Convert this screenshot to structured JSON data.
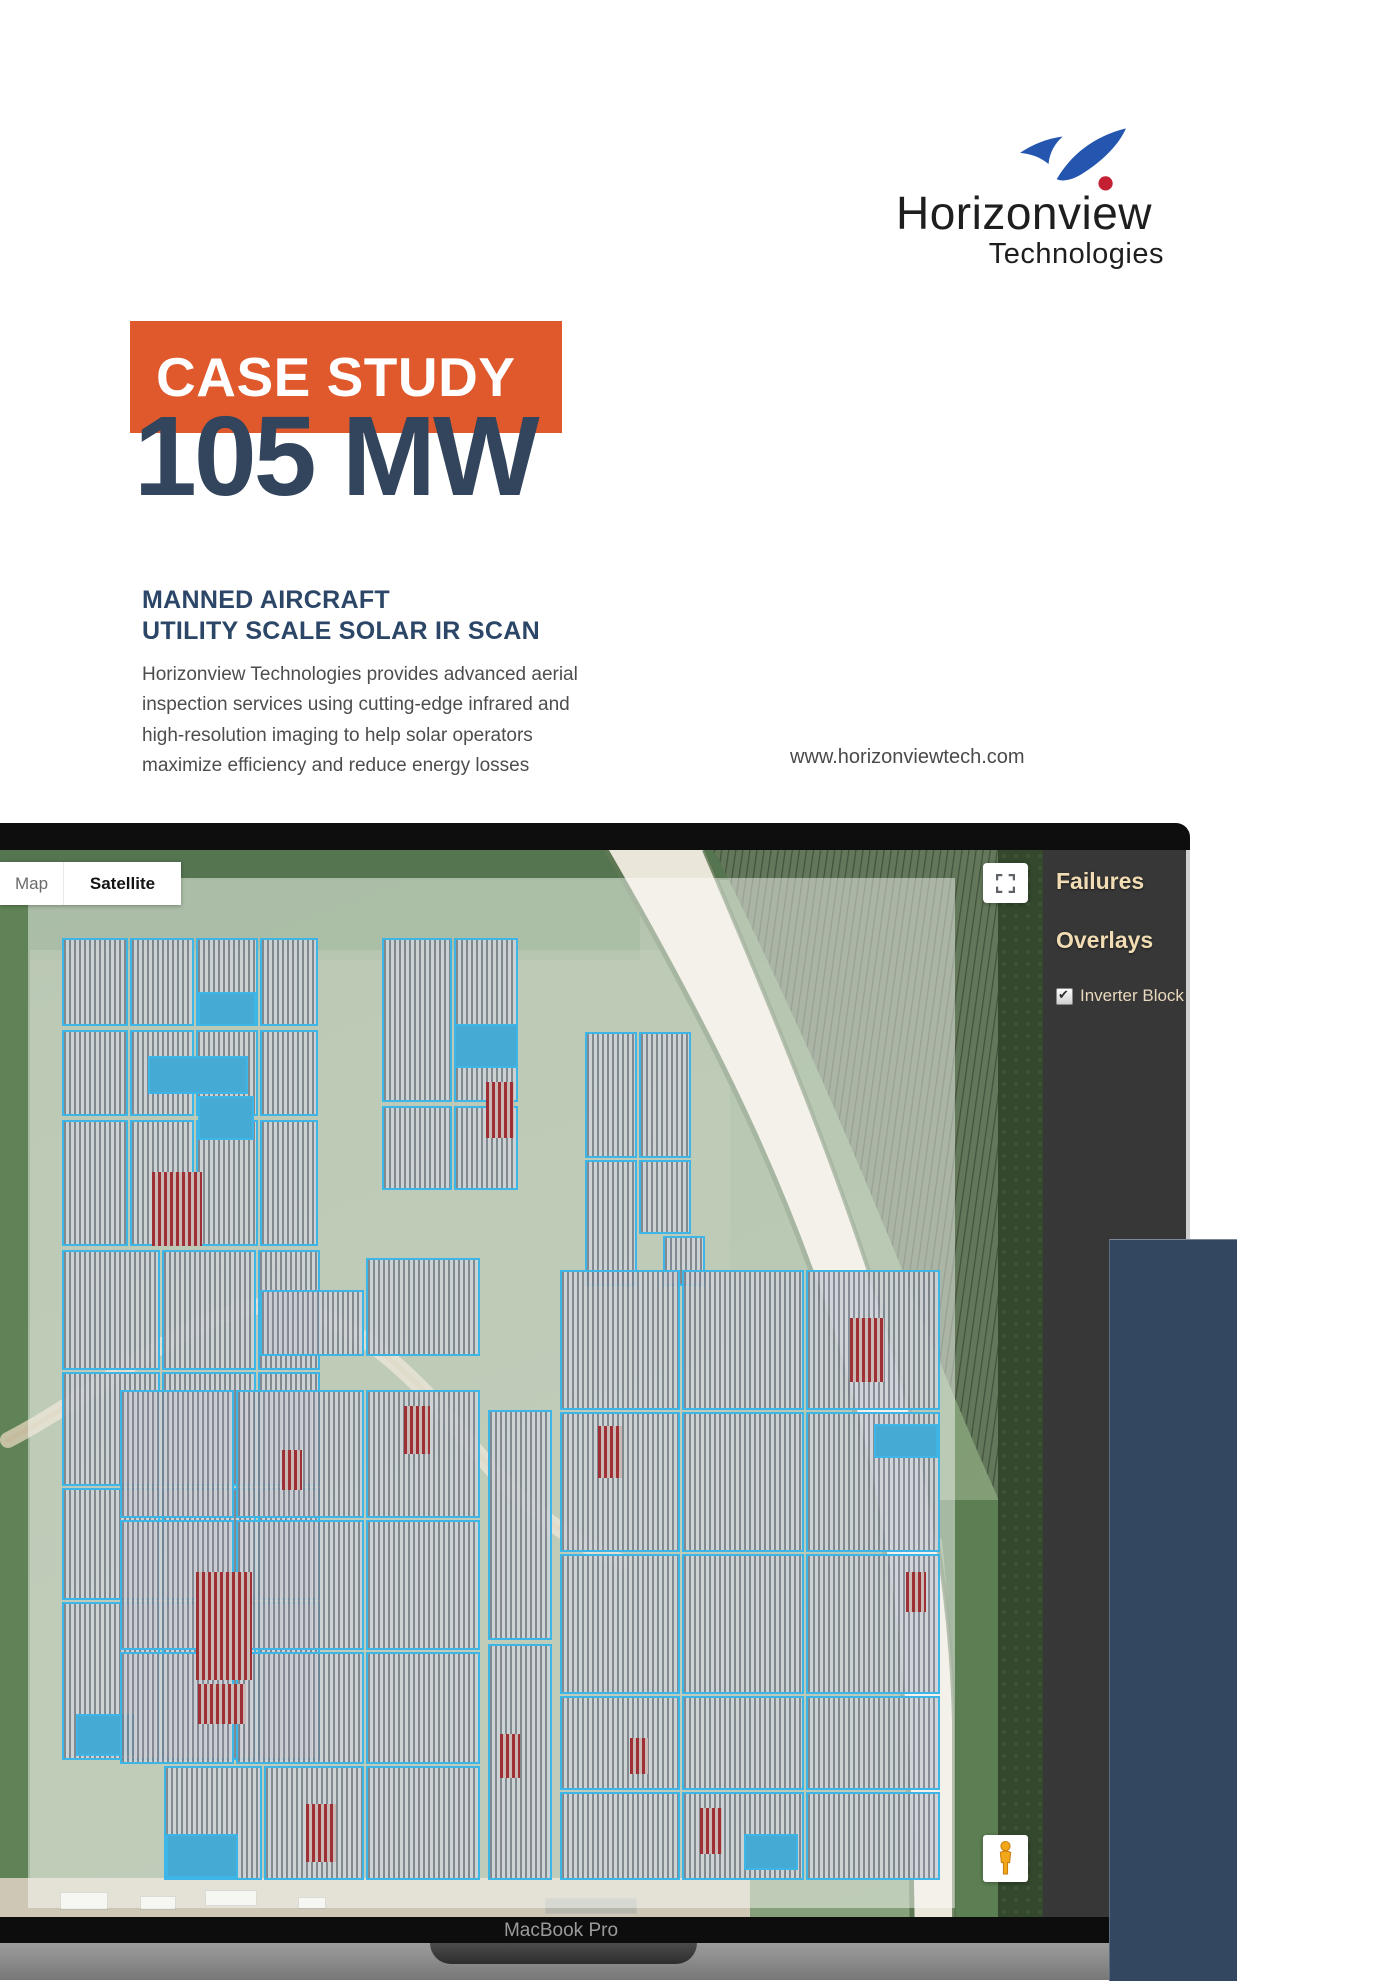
{
  "logo": {
    "name": "Horizonview",
    "subname": "Technologies",
    "icon": "swoosh-bird-icon",
    "blue": "#2456B0",
    "red": "#C42034"
  },
  "hero": {
    "banner_label": "CASE STUDY",
    "banner_bg": "#E0592C",
    "capacity": "105 MW",
    "capacity_color": "#32455C"
  },
  "intro": {
    "heading_line1": "MANNED AIRCRAFT",
    "heading_line2": "UTILITY SCALE SOLAR IR SCAN",
    "body_lines": [
      "Horizonview Technologies provides advanced aerial",
      "inspection services using cutting-edge infrared and",
      "high-resolution imaging to help solar operators",
      "maximize efficiency and reduce energy losses"
    ],
    "website": "www.horizonviewtech.com"
  },
  "laptop": {
    "model_label": "MacBook Pro"
  },
  "map_ui": {
    "map_button": "Map",
    "satellite_button": "Satellite",
    "fullscreen_icon": "fullscreen-icon",
    "pegman_icon": "pegman-icon",
    "block_outline_color": "#3DB5E6",
    "highlight_blue": "#45ABD5",
    "failure_red": "#9E2F35"
  },
  "sidebar": {
    "title": "Failures",
    "section": "Overlays",
    "bg": "#373737",
    "text_color": "#F1DCB4",
    "overlay_item": {
      "label": "Inverter Block",
      "checked": true,
      "check_glyph": "✔"
    }
  },
  "deco": {
    "navy_block_color": "#334760"
  },
  "map": {
    "blocks": [
      {
        "x": 62,
        "y": 88,
        "w": 66,
        "h": 88,
        "t": "p"
      },
      {
        "x": 130,
        "y": 88,
        "w": 64,
        "h": 88,
        "t": "p"
      },
      {
        "x": 196,
        "y": 88,
        "w": 62,
        "h": 88,
        "t": "p"
      },
      {
        "x": 260,
        "y": 88,
        "w": 58,
        "h": 88,
        "t": "p"
      },
      {
        "x": 62,
        "y": 180,
        "w": 66,
        "h": 86,
        "t": "p"
      },
      {
        "x": 130,
        "y": 180,
        "w": 64,
        "h": 86,
        "t": "p"
      },
      {
        "x": 196,
        "y": 180,
        "w": 62,
        "h": 86,
        "t": "p"
      },
      {
        "x": 260,
        "y": 180,
        "w": 58,
        "h": 86,
        "t": "p"
      },
      {
        "x": 62,
        "y": 270,
        "w": 66,
        "h": 126,
        "t": "p"
      },
      {
        "x": 130,
        "y": 270,
        "w": 64,
        "h": 126,
        "t": "p"
      },
      {
        "x": 196,
        "y": 270,
        "w": 62,
        "h": 126,
        "t": "p"
      },
      {
        "x": 260,
        "y": 270,
        "w": 58,
        "h": 126,
        "t": "p"
      },
      {
        "x": 198,
        "y": 142,
        "w": 58,
        "h": 34,
        "t": "b"
      },
      {
        "x": 148,
        "y": 206,
        "w": 100,
        "h": 38,
        "t": "b"
      },
      {
        "x": 198,
        "y": 246,
        "w": 56,
        "h": 44,
        "t": "b"
      },
      {
        "x": 152,
        "y": 322,
        "w": 50,
        "h": 74,
        "t": "r"
      },
      {
        "x": 62,
        "y": 400,
        "w": 98,
        "h": 120,
        "t": "p"
      },
      {
        "x": 162,
        "y": 400,
        "w": 94,
        "h": 120,
        "t": "p"
      },
      {
        "x": 258,
        "y": 400,
        "w": 62,
        "h": 120,
        "t": "p"
      },
      {
        "x": 62,
        "y": 522,
        "w": 98,
        "h": 114,
        "t": "p"
      },
      {
        "x": 162,
        "y": 522,
        "w": 94,
        "h": 114,
        "t": "p"
      },
      {
        "x": 258,
        "y": 522,
        "w": 62,
        "h": 114,
        "t": "p"
      },
      {
        "x": 62,
        "y": 638,
        "w": 98,
        "h": 112,
        "t": "p"
      },
      {
        "x": 162,
        "y": 638,
        "w": 94,
        "h": 112,
        "t": "p"
      },
      {
        "x": 258,
        "y": 638,
        "w": 62,
        "h": 112,
        "t": "p"
      },
      {
        "x": 62,
        "y": 752,
        "w": 98,
        "h": 158,
        "t": "p"
      },
      {
        "x": 162,
        "y": 752,
        "w": 94,
        "h": 158,
        "t": "p"
      },
      {
        "x": 258,
        "y": 752,
        "w": 62,
        "h": 158,
        "t": "p"
      },
      {
        "x": 196,
        "y": 774,
        "w": 56,
        "h": 56,
        "t": "r"
      },
      {
        "x": 198,
        "y": 834,
        "w": 48,
        "h": 40,
        "t": "r"
      },
      {
        "x": 76,
        "y": 864,
        "w": 58,
        "h": 42,
        "t": "b"
      },
      {
        "x": 382,
        "y": 88,
        "w": 70,
        "h": 164,
        "t": "p"
      },
      {
        "x": 454,
        "y": 88,
        "w": 64,
        "h": 164,
        "t": "p"
      },
      {
        "x": 382,
        "y": 256,
        "w": 70,
        "h": 84,
        "t": "p"
      },
      {
        "x": 454,
        "y": 256,
        "w": 64,
        "h": 84,
        "t": "p"
      },
      {
        "x": 454,
        "y": 174,
        "w": 64,
        "h": 44,
        "t": "b"
      },
      {
        "x": 486,
        "y": 232,
        "w": 28,
        "h": 56,
        "t": "r"
      },
      {
        "x": 585,
        "y": 182,
        "w": 52,
        "h": 126,
        "t": "p"
      },
      {
        "x": 639,
        "y": 182,
        "w": 52,
        "h": 126,
        "t": "p"
      },
      {
        "x": 585,
        "y": 310,
        "w": 52,
        "h": 126,
        "t": "p"
      },
      {
        "x": 639,
        "y": 310,
        "w": 52,
        "h": 74,
        "t": "p"
      },
      {
        "x": 663,
        "y": 386,
        "w": 42,
        "h": 50,
        "t": "p"
      },
      {
        "x": 260,
        "y": 440,
        "w": 104,
        "h": 66,
        "t": "p"
      },
      {
        "x": 366,
        "y": 408,
        "w": 114,
        "h": 98,
        "t": "p"
      },
      {
        "x": 120,
        "y": 540,
        "w": 114,
        "h": 128,
        "t": "p"
      },
      {
        "x": 236,
        "y": 540,
        "w": 128,
        "h": 128,
        "t": "p"
      },
      {
        "x": 366,
        "y": 540,
        "w": 114,
        "h": 128,
        "t": "p"
      },
      {
        "x": 120,
        "y": 670,
        "w": 114,
        "h": 130,
        "t": "p"
      },
      {
        "x": 236,
        "y": 670,
        "w": 128,
        "h": 130,
        "t": "p"
      },
      {
        "x": 366,
        "y": 670,
        "w": 114,
        "h": 130,
        "t": "p"
      },
      {
        "x": 120,
        "y": 802,
        "w": 114,
        "h": 112,
        "t": "p"
      },
      {
        "x": 236,
        "y": 802,
        "w": 128,
        "h": 112,
        "t": "p"
      },
      {
        "x": 366,
        "y": 802,
        "w": 114,
        "h": 112,
        "t": "p"
      },
      {
        "x": 164,
        "y": 916,
        "w": 98,
        "h": 114,
        "t": "p"
      },
      {
        "x": 264,
        "y": 916,
        "w": 100,
        "h": 114,
        "t": "p"
      },
      {
        "x": 366,
        "y": 916,
        "w": 114,
        "h": 114,
        "t": "p"
      },
      {
        "x": 196,
        "y": 722,
        "w": 56,
        "h": 60,
        "t": "r"
      },
      {
        "x": 404,
        "y": 556,
        "w": 26,
        "h": 48,
        "t": "r"
      },
      {
        "x": 306,
        "y": 954,
        "w": 30,
        "h": 58,
        "t": "r"
      },
      {
        "x": 282,
        "y": 600,
        "w": 20,
        "h": 40,
        "t": "r"
      },
      {
        "x": 166,
        "y": 984,
        "w": 72,
        "h": 44,
        "t": "b"
      },
      {
        "x": 488,
        "y": 560,
        "w": 64,
        "h": 230,
        "t": "p"
      },
      {
        "x": 488,
        "y": 794,
        "w": 64,
        "h": 236,
        "t": "p"
      },
      {
        "x": 500,
        "y": 884,
        "w": 20,
        "h": 44,
        "t": "r"
      },
      {
        "x": 560,
        "y": 420,
        "w": 120,
        "h": 140,
        "t": "p"
      },
      {
        "x": 682,
        "y": 420,
        "w": 122,
        "h": 140,
        "t": "p"
      },
      {
        "x": 806,
        "y": 420,
        "w": 134,
        "h": 140,
        "t": "p"
      },
      {
        "x": 560,
        "y": 562,
        "w": 120,
        "h": 140,
        "t": "p"
      },
      {
        "x": 682,
        "y": 562,
        "w": 122,
        "h": 140,
        "t": "p"
      },
      {
        "x": 806,
        "y": 562,
        "w": 134,
        "h": 140,
        "t": "p"
      },
      {
        "x": 560,
        "y": 704,
        "w": 120,
        "h": 140,
        "t": "p"
      },
      {
        "x": 682,
        "y": 704,
        "w": 122,
        "h": 140,
        "t": "p"
      },
      {
        "x": 806,
        "y": 704,
        "w": 134,
        "h": 140,
        "t": "p"
      },
      {
        "x": 560,
        "y": 846,
        "w": 120,
        "h": 94,
        "t": "p"
      },
      {
        "x": 682,
        "y": 846,
        "w": 122,
        "h": 94,
        "t": "p"
      },
      {
        "x": 806,
        "y": 846,
        "w": 134,
        "h": 94,
        "t": "p"
      },
      {
        "x": 560,
        "y": 942,
        "w": 120,
        "h": 88,
        "t": "p"
      },
      {
        "x": 682,
        "y": 942,
        "w": 122,
        "h": 88,
        "t": "p"
      },
      {
        "x": 806,
        "y": 942,
        "w": 134,
        "h": 88,
        "t": "p"
      },
      {
        "x": 598,
        "y": 576,
        "w": 24,
        "h": 52,
        "t": "r"
      },
      {
        "x": 850,
        "y": 468,
        "w": 34,
        "h": 64,
        "t": "r"
      },
      {
        "x": 906,
        "y": 722,
        "w": 20,
        "h": 40,
        "t": "r"
      },
      {
        "x": 700,
        "y": 958,
        "w": 22,
        "h": 46,
        "t": "r"
      },
      {
        "x": 630,
        "y": 888,
        "w": 18,
        "h": 36,
        "t": "r"
      },
      {
        "x": 874,
        "y": 574,
        "w": 64,
        "h": 34,
        "t": "b"
      },
      {
        "x": 744,
        "y": 984,
        "w": 54,
        "h": 36,
        "t": "b"
      }
    ]
  }
}
